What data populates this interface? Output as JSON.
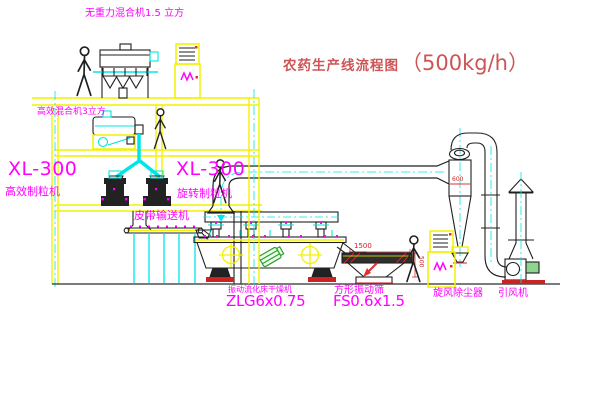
{
  "title": {
    "name": "农药生产线流程图",
    "capacity": "（500kg/h）"
  },
  "labels": {
    "gravity_mixer": "无重力混合机1.5 立方",
    "high_eff_mixer": "高效混合机3立方",
    "granulator_left_model": "XL-300",
    "granulator_left_name": "高效制粒机",
    "granulator_right_model": "XL-300",
    "granulator_right_name": "旋转制粒机",
    "belt_conveyor": "皮带输送机",
    "dryer_name": "振动流化床干燥机",
    "dryer_model": "ZLG6x0.75",
    "screen_name": "方形振动筛",
    "screen_model": "FS0.6x1.5",
    "cyclone": "旋风除尘器",
    "fan": "引风机"
  },
  "dimensions": {
    "screen_length": "1500",
    "screen_side": "500",
    "cyclone_outlet": "600"
  },
  "colors": {
    "line_yellow": "#f2f200",
    "line_cyan": "#00e6e6",
    "label_magenta": "#ff00ff",
    "accent_red": "#e03030",
    "title_red": "#cd5555",
    "machine_dark": "#1f1f1f",
    "motor_green": "#2f9e2f"
  }
}
